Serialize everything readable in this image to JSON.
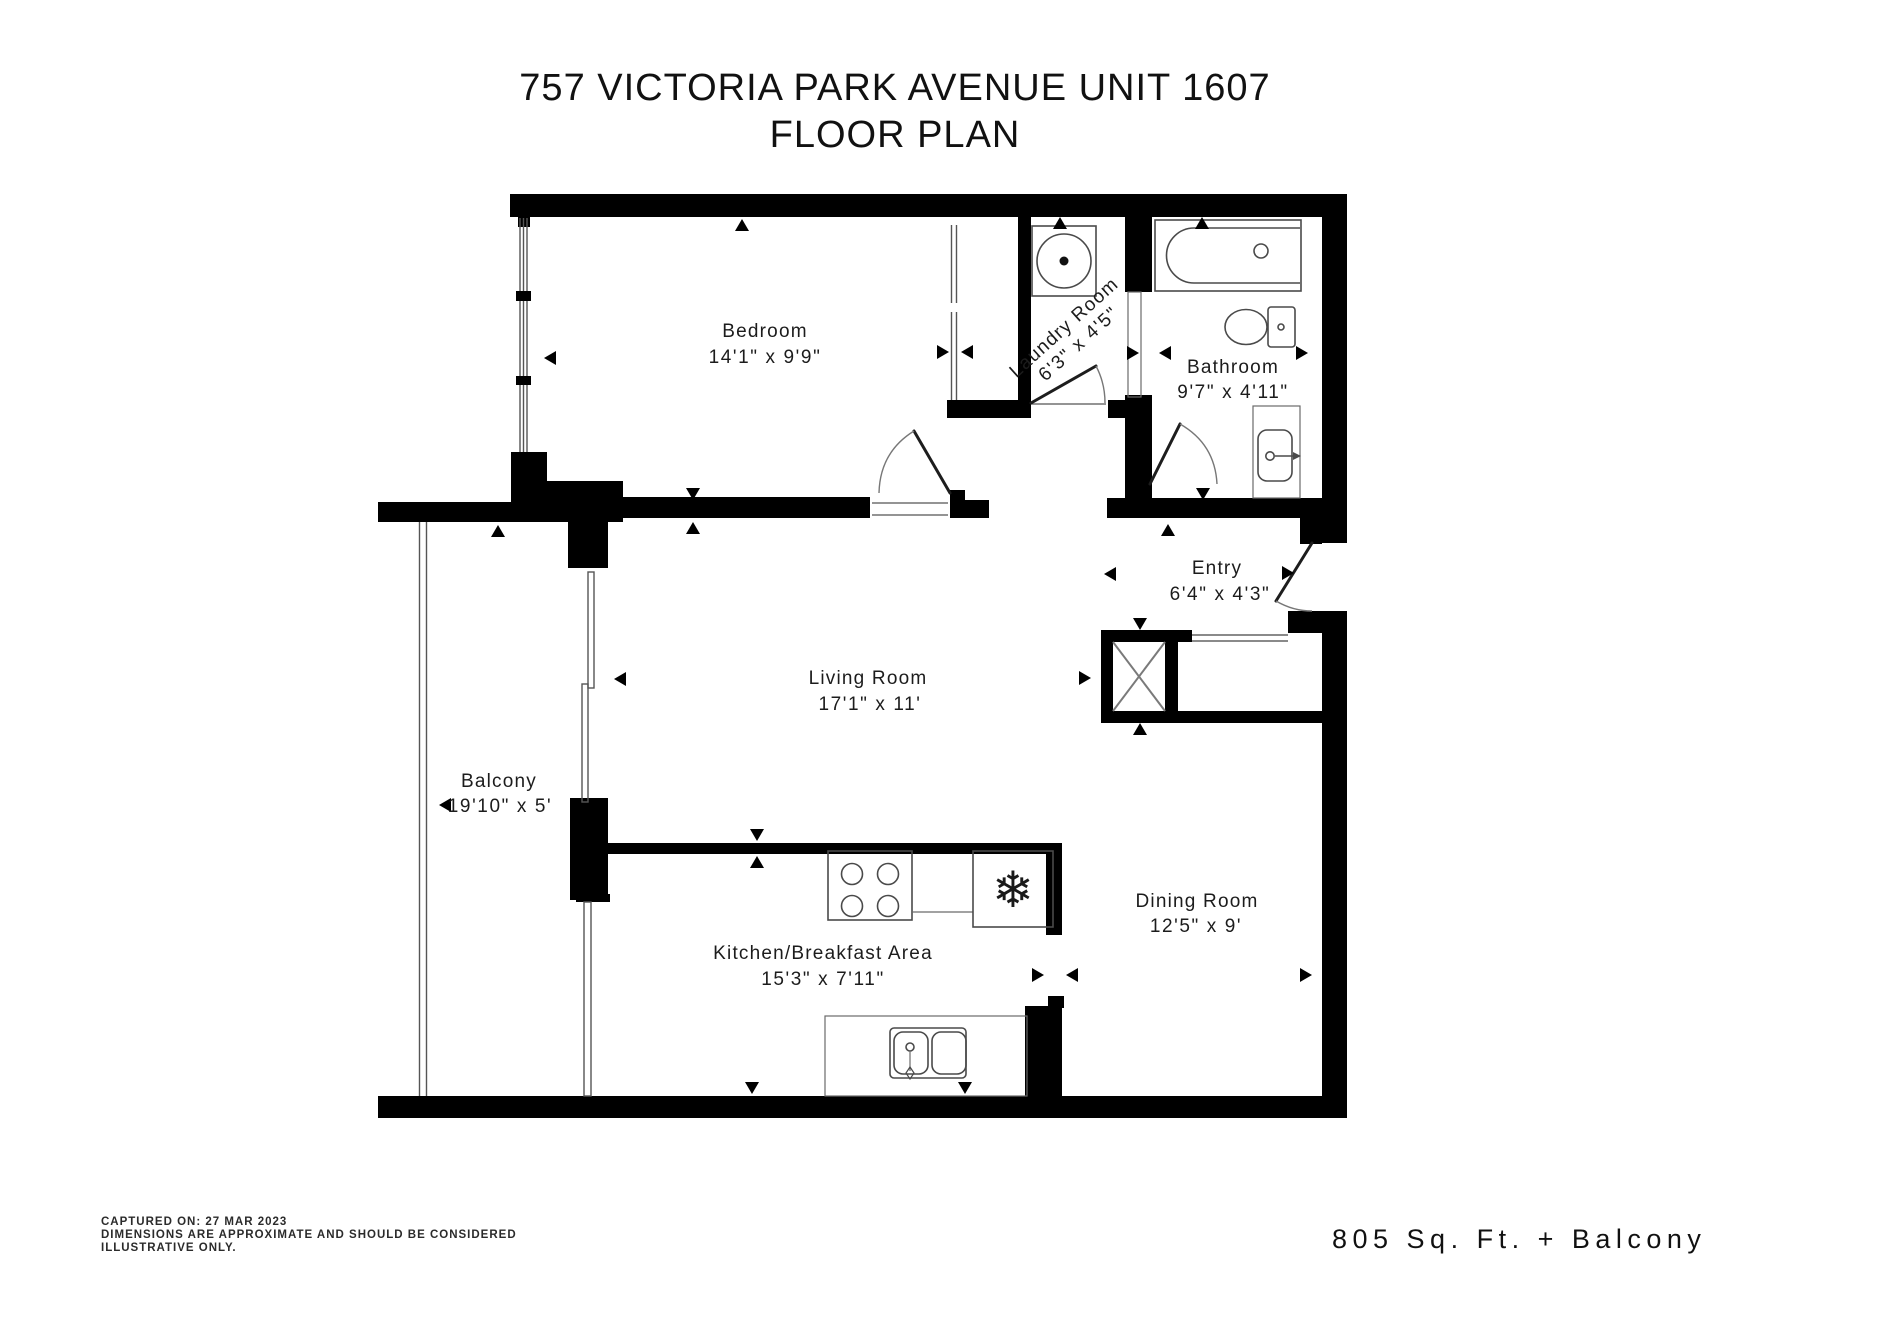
{
  "title": {
    "line1": "757 VICTORIA PARK AVENUE UNIT 1607",
    "line2": "FLOOR PLAN"
  },
  "rooms": [
    {
      "id": "bedroom",
      "name": "Bedroom",
      "dims": "14'1\" x 9'9\""
    },
    {
      "id": "laundry",
      "name": "Laundry Room",
      "dims": "6'3\" x 4'5\""
    },
    {
      "id": "bathroom",
      "name": "Bathroom",
      "dims": "9'7\" x 4'11\""
    },
    {
      "id": "entry",
      "name": "Entry",
      "dims": "6'4\" x 4'3\""
    },
    {
      "id": "living",
      "name": "Living Room",
      "dims": "17'1\" x 11'"
    },
    {
      "id": "balcony",
      "name": "Balcony",
      "dims": "19'10\" x 5'"
    },
    {
      "id": "kitchen",
      "name": "Kitchen/Breakfast Area",
      "dims": "15'3\" x 7'11\""
    },
    {
      "id": "dining",
      "name": "Dining Room",
      "dims": "12'5\" x 9'"
    }
  ],
  "footer": {
    "disclaimer_line1": "CAPTURED ON: 27 MAR 2023",
    "disclaimer_line2": "DIMENSIONS ARE APPROXIMATE AND SHOULD BE CONSIDERED",
    "disclaimer_line3": "ILLUSTRATIVE ONLY.",
    "area_text": "805 Sq. Ft. + Balcony"
  },
  "icons": {
    "snowflake": "❄"
  },
  "colors": {
    "wall": "#000000",
    "fixture": "#4a4a4a",
    "background": "#ffffff",
    "text": "#1a1a1a"
  }
}
